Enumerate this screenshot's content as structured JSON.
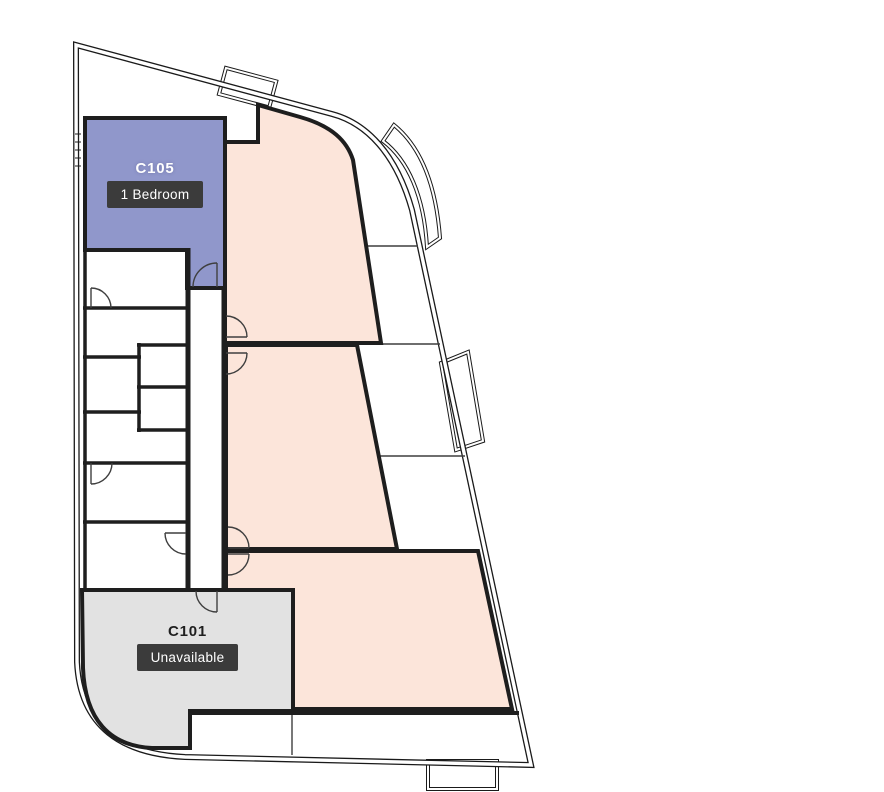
{
  "floorplan": {
    "units": [
      {
        "id": "C105",
        "badge": "1 Bedroom",
        "availability": "available"
      },
      {
        "id": "C101",
        "badge": "Unavailable",
        "availability": "unavailable"
      }
    ],
    "colors": {
      "available": "#9097cb",
      "unavailable": "#e2e2e2",
      "highlighted": "#fce5da",
      "wall": "#1e1e1e",
      "outer_wall": "#1a1a1a",
      "door": "#3f3f3f",
      "badge_background": "#3b3b3b",
      "badge_text": "#ffffff",
      "background": "#ffffff"
    }
  }
}
